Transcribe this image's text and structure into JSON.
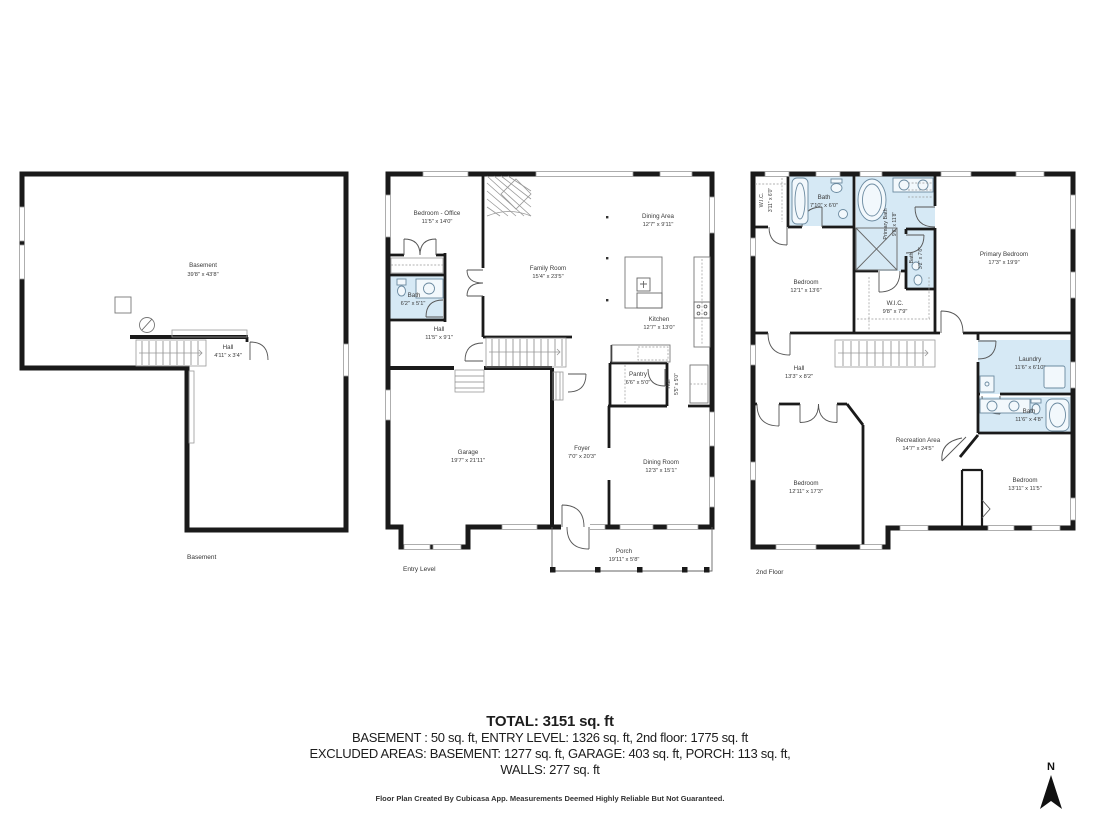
{
  "floors": [
    {
      "name": "Basement",
      "rooms": [
        {
          "label": "Basement",
          "dims": "39'8\" x 43'8\""
        },
        {
          "label": "Hall",
          "dims": "4'11\" x 3'4\""
        }
      ]
    },
    {
      "name": "Entry Level",
      "rooms": [
        {
          "label": "Bedroom - Office",
          "dims": "11'5\" x 14'0\""
        },
        {
          "label": "Bath",
          "dims": "6'2\" x 5'1\""
        },
        {
          "label": "Hall",
          "dims": "11'5\" x 9'1\""
        },
        {
          "label": "Family Room",
          "dims": "15'4\" x 23'5\""
        },
        {
          "label": "Dining Area",
          "dims": "12'7\" x 9'11\""
        },
        {
          "label": "Kitchen",
          "dims": "12'7\" x 13'0\""
        },
        {
          "label": "Pantry",
          "dims": "6'6\" x 5'0\""
        },
        {
          "label": "Hall",
          "dims": "5'5\" x 5'0\""
        },
        {
          "label": "Garage",
          "dims": "19'7\" x 21'11\""
        },
        {
          "label": "Foyer",
          "dims": "7'0\" x 20'3\""
        },
        {
          "label": "Dining Room",
          "dims": "12'3\" x 15'1\""
        },
        {
          "label": "Porch",
          "dims": "19'11\" x 5'8\""
        }
      ]
    },
    {
      "name": "2nd Floor",
      "rooms": [
        {
          "label": "W.I.C.",
          "dims": "3'11\" x 6'0\""
        },
        {
          "label": "Bath",
          "dims": "7'10\" x 6'0\""
        },
        {
          "label": "Primary Bath",
          "dims": "9'8\" x 11'8\""
        },
        {
          "label": "Bath",
          "dims": "3'2\" x 7'6\""
        },
        {
          "label": "Primary Bedroom",
          "dims": "17'3\" x 19'9\""
        },
        {
          "label": "Bedroom",
          "dims": "12'1\" x 13'6\""
        },
        {
          "label": "W.I.C.",
          "dims": "9'8\" x 7'9\""
        },
        {
          "label": "Hall",
          "dims": "13'3\" x 8'2\""
        },
        {
          "label": "Laundry",
          "dims": "11'6\" x 6'10\""
        },
        {
          "label": "Bath",
          "dims": "11'6\" x 4'8\""
        },
        {
          "label": "Recreation Area",
          "dims": "14'7\" x 24'5\""
        },
        {
          "label": "Bedroom",
          "dims": "12'11\" x 17'3\""
        },
        {
          "label": "Bedroom",
          "dims": "13'11\" x 11'5\""
        }
      ]
    }
  ],
  "summary": {
    "total_line": "TOTAL: 3151 sq. ft",
    "floors_line": "BASEMENT : 50 sq. ft, ENTRY LEVEL: 1326 sq. ft, 2nd floor: 1775 sq. ft",
    "excluded_line": "EXCLUDED AREAS: BASEMENT: 1277 sq. ft, GARAGE: 403 sq. ft, PORCH: 113 sq. ft,",
    "walls_line": "WALLS: 277 sq. ft",
    "credit_line": "Floor Plan Created By Cubicasa App. Measurements Deemed Highly Reliable But Not Guaranteed."
  },
  "compass": {
    "label": "N"
  },
  "colors": {
    "wall": "#1a1a1a",
    "wet_room": "#d6e9f5"
  }
}
